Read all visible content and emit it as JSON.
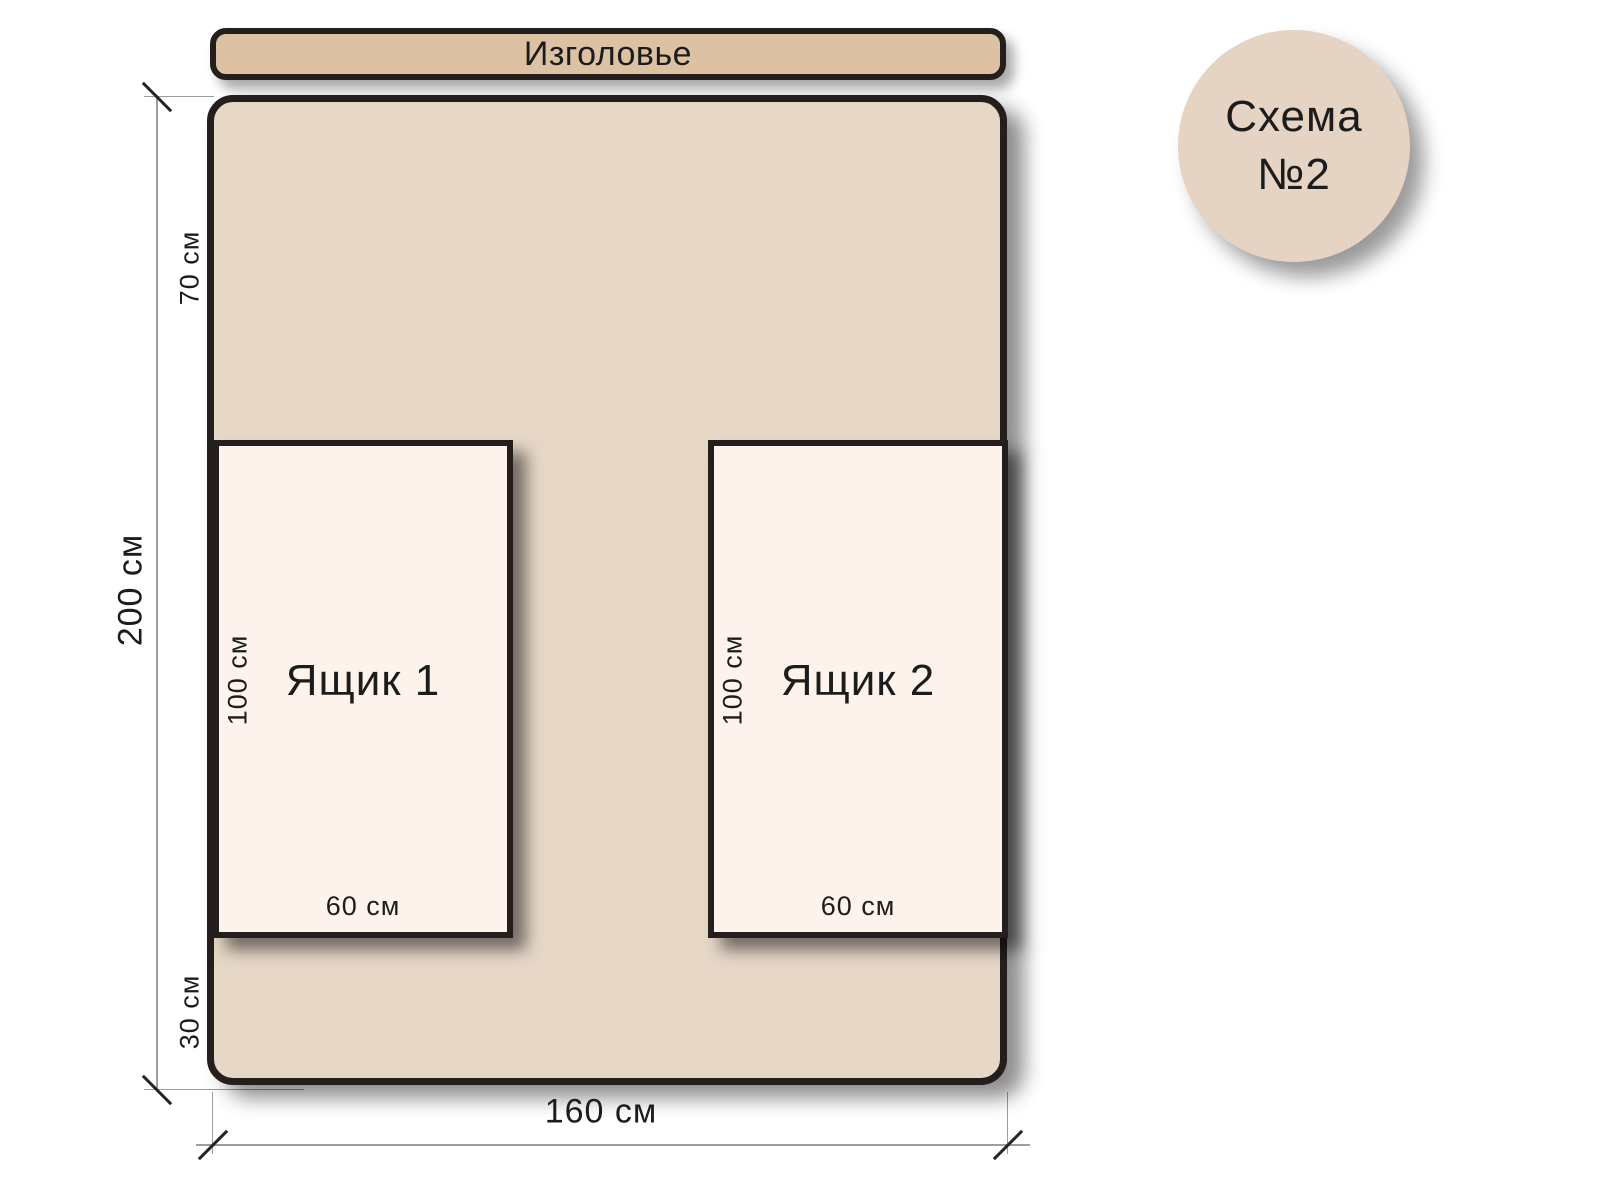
{
  "badge": {
    "line1": "Схема",
    "line2": "№2"
  },
  "headboard": {
    "label": "Изголовье"
  },
  "dimensions": {
    "head_offset": "70 см",
    "total_height": "200 см",
    "foot_offset": "30 см",
    "total_width": "160 см"
  },
  "drawers": [
    {
      "name": "Ящик 1",
      "height_label": "100 см",
      "width_label": "60 см"
    },
    {
      "name": "Ящик 2",
      "height_label": "100 см",
      "width_label": "60 см"
    }
  ],
  "colors": {
    "background": "#ffffff",
    "headboard_fill": "#dcc2a3",
    "bed_fill": "#e7d7c7",
    "drawer_fill": "#fdf3ec",
    "badge_fill": "#e5d3c3",
    "outline": "#241f1d",
    "dimension_line": "#9d9d9d",
    "text": "#1c1c1c"
  }
}
